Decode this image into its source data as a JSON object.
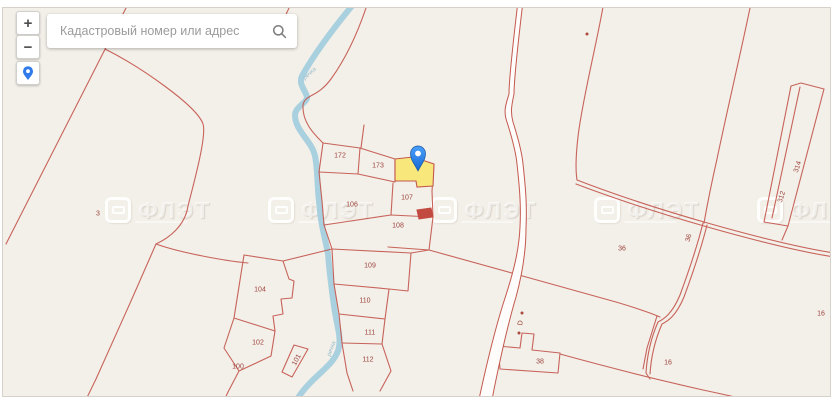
{
  "search": {
    "placeholder": "Кадастровый номер или адрес"
  },
  "controls": {
    "zoom_in_label": "+",
    "zoom_out_label": "−"
  },
  "map": {
    "background": "#f3efe9",
    "line_color": "#c4584e",
    "label_color": "#9c453d",
    "water_color": "#a9d0de",
    "road_fill": "#fefdfb",
    "highlight_fill": "#f8e87c",
    "marker": {
      "x": 417,
      "y": 170
    },
    "watermark": {
      "text": "ФЛЭТ",
      "tile_xs": [
        104,
        267,
        430,
        593,
        756
      ],
      "y": 196
    },
    "labels": [
      {
        "t": "172",
        "x": 339,
        "y": 155
      },
      {
        "t": "173",
        "x": 377,
        "y": 165
      },
      {
        "t": "107",
        "x": 406,
        "y": 197
      },
      {
        "t": "106",
        "x": 351,
        "y": 204
      },
      {
        "t": "108",
        "x": 397,
        "y": 225
      },
      {
        "t": "109",
        "x": 369,
        "y": 265
      },
      {
        "t": "110",
        "x": 364,
        "y": 300
      },
      {
        "t": "111",
        "x": 369,
        "y": 332
      },
      {
        "t": "112",
        "x": 367,
        "y": 359
      },
      {
        "t": "104",
        "x": 259,
        "y": 289
      },
      {
        "t": "102",
        "x": 257,
        "y": 342
      },
      {
        "t": "101",
        "x": 296,
        "y": 359,
        "r": -62
      },
      {
        "t": "100",
        "x": 237,
        "y": 366
      },
      {
        "t": "3",
        "x": 97,
        "y": 213
      },
      {
        "t": "36",
        "x": 621,
        "y": 248
      },
      {
        "t": "36",
        "x": 688,
        "y": 237,
        "r": -75
      },
      {
        "t": "314",
        "x": 797,
        "y": 166,
        "r": -72
      },
      {
        "t": "312",
        "x": 781,
        "y": 196,
        "r": -72
      },
      {
        "t": "38",
        "x": 539,
        "y": 361
      },
      {
        "t": "16",
        "x": 667,
        "y": 362
      },
      {
        "t": "16",
        "x": 820,
        "y": 313
      },
      {
        "t": "D",
        "x": 520,
        "y": 322,
        "r": -80
      }
    ],
    "river_labels": [
      {
        "t": "речка",
        "x": 309,
        "y": 73,
        "r": -42
      },
      {
        "t": "речка",
        "x": 331,
        "y": 348,
        "r": -70
      }
    ],
    "dots": [
      {
        "x": 586,
        "y": 33
      },
      {
        "x": 521,
        "y": 312
      },
      {
        "x": 518,
        "y": 332
      }
    ]
  }
}
